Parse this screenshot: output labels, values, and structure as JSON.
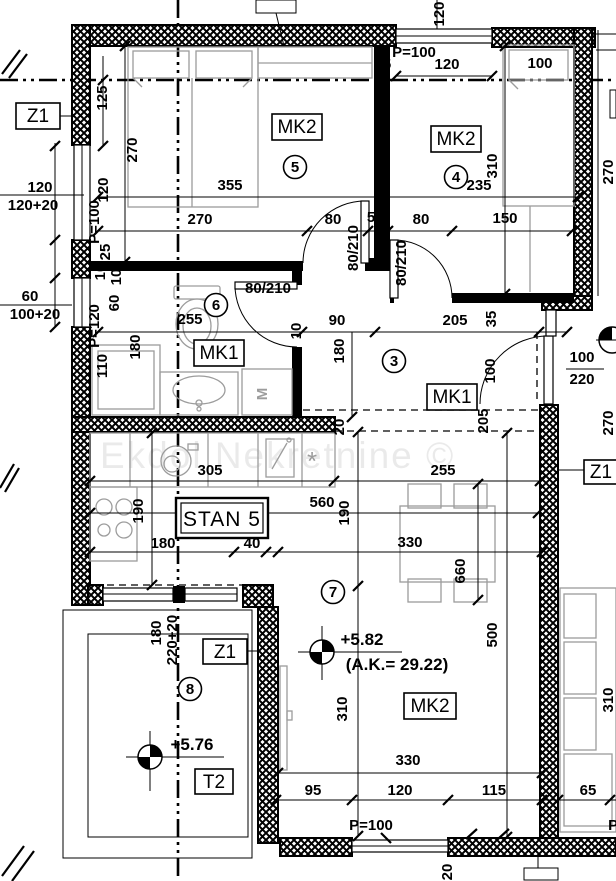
{
  "watermark": "Ekdol Nekretnine ©",
  "unit": {
    "stan": "STAN 5",
    "t2": "T2",
    "z1": "Z1"
  },
  "codes": {
    "mk1": "MK1",
    "mk2": "MK2",
    "machine": "M",
    "stove": "*"
  },
  "room_numbers": {
    "hall": "3",
    "bedroom2": "4",
    "bedroom1": "5",
    "bathroom": "6",
    "living": "7",
    "terrace": "8"
  },
  "levels": {
    "living": "+5.82",
    "living_ak": "(A.K.= 29.22)",
    "terrace": "+5.76"
  },
  "doors": {
    "standard": "80/210",
    "balcony_w": "100",
    "balcony_h": "220"
  },
  "windows": {
    "p100": "P=100",
    "p120": "P=120"
  },
  "dims": {
    "n5": "5",
    "n10": "10",
    "n20": "20",
    "n25": "25",
    "n35": "35",
    "n40": "40",
    "n60": "60",
    "n65": "65",
    "n80": "80",
    "n90": "90",
    "n95": "95",
    "n100": "100",
    "n110": "110",
    "n115": "115",
    "n120": "120",
    "n125": "125",
    "n150": "150",
    "n180": "180",
    "n190": "190",
    "n205": "205",
    "n235": "235",
    "n255": "255",
    "n270": "270",
    "n305": "305",
    "n310": "310",
    "n330": "330",
    "n355": "355",
    "n500": "500",
    "n560": "560",
    "n660": "660",
    "n100_20": "100+20",
    "n120_20": "120+20",
    "n220_20": "220+20"
  }
}
